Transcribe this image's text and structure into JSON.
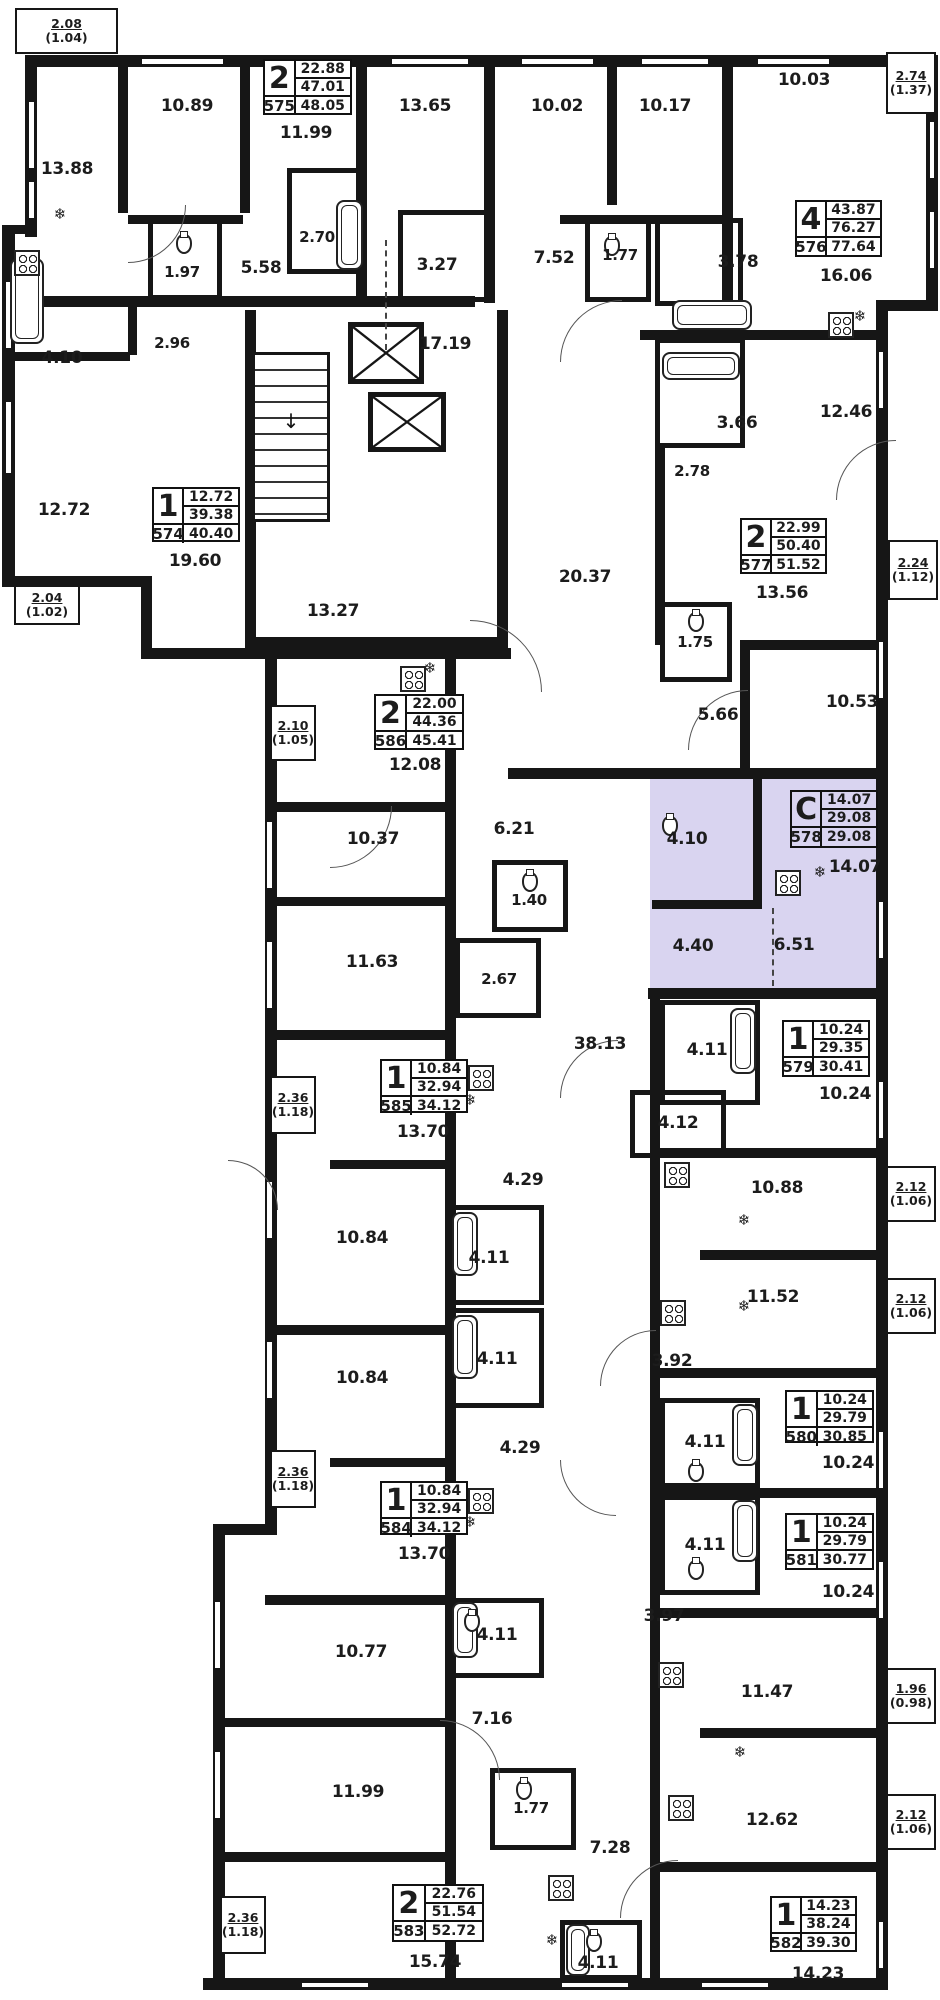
{
  "title": "Residential floor plan",
  "highlight": {
    "apartment_id": "578",
    "color": "#d9d4f0",
    "type_letter": "С"
  },
  "apartments": [
    {
      "id": "575",
      "rooms": "2",
      "values": [
        "22.88",
        "47.01",
        "48.05"
      ],
      "x": 263,
      "y": 59,
      "w": 89,
      "h": 56,
      "highlighted": false
    },
    {
      "id": "576",
      "rooms": "4",
      "values": [
        "43.87",
        "76.27",
        "77.64"
      ],
      "x": 795,
      "y": 200,
      "w": 87,
      "h": 57,
      "highlighted": false
    },
    {
      "id": "574",
      "rooms": "1",
      "values": [
        "12.72",
        "39.38",
        "40.40"
      ],
      "x": 152,
      "y": 487,
      "w": 88,
      "h": 55,
      "highlighted": false
    },
    {
      "id": "577",
      "rooms": "2",
      "values": [
        "22.99",
        "50.40",
        "51.52"
      ],
      "x": 740,
      "y": 518,
      "w": 87,
      "h": 56,
      "highlighted": false
    },
    {
      "id": "586",
      "rooms": "2",
      "values": [
        "22.00",
        "44.36",
        "45.41"
      ],
      "x": 374,
      "y": 694,
      "w": 90,
      "h": 56,
      "highlighted": false
    },
    {
      "id": "578",
      "rooms": "С",
      "values": [
        "14.07",
        "29.08",
        "29.08"
      ],
      "x": 790,
      "y": 790,
      "w": 88,
      "h": 58,
      "highlighted": true
    },
    {
      "id": "579",
      "rooms": "1",
      "values": [
        "10.24",
        "29.35",
        "30.41"
      ],
      "x": 782,
      "y": 1020,
      "w": 88,
      "h": 57,
      "highlighted": false
    },
    {
      "id": "585",
      "rooms": "1",
      "values": [
        "10.84",
        "32.94",
        "34.12"
      ],
      "x": 380,
      "y": 1059,
      "w": 88,
      "h": 54,
      "highlighted": false
    },
    {
      "id": "580",
      "rooms": "1",
      "values": [
        "10.24",
        "29.79",
        "30.85"
      ],
      "x": 785,
      "y": 1390,
      "w": 89,
      "h": 53,
      "highlighted": false
    },
    {
      "id": "581",
      "rooms": "1",
      "values": [
        "10.24",
        "29.79",
        "30.77"
      ],
      "x": 785,
      "y": 1513,
      "w": 89,
      "h": 57,
      "highlighted": false
    },
    {
      "id": "584",
      "rooms": "1",
      "values": [
        "10.84",
        "32.94",
        "34.12"
      ],
      "x": 380,
      "y": 1481,
      "w": 88,
      "h": 54,
      "highlighted": false
    },
    {
      "id": "583",
      "rooms": "2",
      "values": [
        "22.76",
        "51.54",
        "52.72"
      ],
      "x": 392,
      "y": 1884,
      "w": 92,
      "h": 58,
      "highlighted": false
    },
    {
      "id": "582",
      "rooms": "1",
      "values": [
        "14.23",
        "38.24",
        "39.30"
      ],
      "x": 770,
      "y": 1896,
      "w": 87,
      "h": 56,
      "highlighted": false
    }
  ],
  "room_labels": [
    {
      "t": "13.88",
      "x": 67,
      "y": 169
    },
    {
      "t": "10.89",
      "x": 187,
      "y": 106
    },
    {
      "t": "11.99",
      "x": 306,
      "y": 133
    },
    {
      "t": "13.65",
      "x": 425,
      "y": 106
    },
    {
      "t": "10.02",
      "x": 557,
      "y": 106
    },
    {
      "t": "10.17",
      "x": 665,
      "y": 106
    },
    {
      "t": "10.03",
      "x": 804,
      "y": 80
    },
    {
      "t": "2.70",
      "x": 317,
      "y": 237
    },
    {
      "t": "1.97",
      "x": 182,
      "y": 272
    },
    {
      "t": "5.58",
      "x": 261,
      "y": 268
    },
    {
      "t": "3.27",
      "x": 437,
      "y": 265
    },
    {
      "t": "7.52",
      "x": 554,
      "y": 258
    },
    {
      "t": "1.77",
      "x": 620,
      "y": 255
    },
    {
      "t": "3.78",
      "x": 738,
      "y": 262
    },
    {
      "t": "16.06",
      "x": 846,
      "y": 276
    },
    {
      "t": "2.96",
      "x": 172,
      "y": 343
    },
    {
      "t": "4.10",
      "x": 62,
      "y": 358
    },
    {
      "t": "17.19",
      "x": 445,
      "y": 344
    },
    {
      "t": "3.66",
      "x": 737,
      "y": 423
    },
    {
      "t": "12.46",
      "x": 846,
      "y": 412
    },
    {
      "t": "12.72",
      "x": 64,
      "y": 510
    },
    {
      "t": "19.60",
      "x": 195,
      "y": 561
    },
    {
      "t": "2.78",
      "x": 692,
      "y": 471
    },
    {
      "t": "13.56",
      "x": 782,
      "y": 593
    },
    {
      "t": "13.27",
      "x": 333,
      "y": 611
    },
    {
      "t": "20.37",
      "x": 585,
      "y": 577
    },
    {
      "t": "1.75",
      "x": 695,
      "y": 642
    },
    {
      "t": "5.66",
      "x": 718,
      "y": 715
    },
    {
      "t": "10.53",
      "x": 852,
      "y": 702
    },
    {
      "t": "12.08",
      "x": 415,
      "y": 765
    },
    {
      "t": "6.21",
      "x": 514,
      "y": 829
    },
    {
      "t": "10.37",
      "x": 373,
      "y": 839
    },
    {
      "t": "1.40",
      "x": 529,
      "y": 900
    },
    {
      "t": "11.63",
      "x": 372,
      "y": 962
    },
    {
      "t": "2.67",
      "x": 499,
      "y": 979
    },
    {
      "t": "4.10",
      "x": 687,
      "y": 839
    },
    {
      "t": "14.07",
      "x": 855,
      "y": 867
    },
    {
      "t": "4.40",
      "x": 693,
      "y": 946
    },
    {
      "t": "6.51",
      "x": 794,
      "y": 945
    },
    {
      "t": "38.13",
      "x": 600,
      "y": 1044
    },
    {
      "t": "4.11",
      "x": 707,
      "y": 1050
    },
    {
      "t": "10.24",
      "x": 845,
      "y": 1094
    },
    {
      "t": "4.12",
      "x": 678,
      "y": 1123
    },
    {
      "t": "10.88",
      "x": 777,
      "y": 1188
    },
    {
      "t": "13.70",
      "x": 423,
      "y": 1132
    },
    {
      "t": "10.84",
      "x": 362,
      "y": 1238
    },
    {
      "t": "4.11",
      "x": 489,
      "y": 1258
    },
    {
      "t": "4.29",
      "x": 523,
      "y": 1180
    },
    {
      "t": "11.52",
      "x": 773,
      "y": 1297
    },
    {
      "t": "3.92",
      "x": 672,
      "y": 1361
    },
    {
      "t": "10.24",
      "x": 848,
      "y": 1463
    },
    {
      "t": "4.11",
      "x": 705,
      "y": 1442
    },
    {
      "t": "4.11",
      "x": 497,
      "y": 1359
    },
    {
      "t": "10.84",
      "x": 362,
      "y": 1378
    },
    {
      "t": "4.29",
      "x": 520,
      "y": 1448
    },
    {
      "t": "10.24",
      "x": 848,
      "y": 1592
    },
    {
      "t": "4.11",
      "x": 705,
      "y": 1545
    },
    {
      "t": "13.70",
      "x": 424,
      "y": 1554
    },
    {
      "t": "3.97",
      "x": 664,
      "y": 1616
    },
    {
      "t": "10.77",
      "x": 361,
      "y": 1652
    },
    {
      "t": "4.11",
      "x": 497,
      "y": 1635
    },
    {
      "t": "7.16",
      "x": 492,
      "y": 1719
    },
    {
      "t": "11.47",
      "x": 767,
      "y": 1692
    },
    {
      "t": "11.99",
      "x": 358,
      "y": 1792
    },
    {
      "t": "1.77",
      "x": 531,
      "y": 1808
    },
    {
      "t": "7.28",
      "x": 610,
      "y": 1848
    },
    {
      "t": "12.62",
      "x": 772,
      "y": 1820
    },
    {
      "t": "4.11",
      "x": 598,
      "y": 1963
    },
    {
      "t": "15.74",
      "x": 435,
      "y": 1962
    },
    {
      "t": "14.23",
      "x": 818,
      "y": 1974
    }
  ],
  "balconies": [
    {
      "a": "2.08",
      "b": "(1.04)",
      "x": 15,
      "y": 8,
      "w": 103,
      "h": 46
    },
    {
      "a": "2.74",
      "b": "(1.37)",
      "x": 886,
      "y": 52,
      "w": 50,
      "h": 62
    },
    {
      "a": "2.04",
      "b": "(1.02)",
      "x": 14,
      "y": 585,
      "w": 66,
      "h": 40
    },
    {
      "a": "2.24",
      "b": "(1.12)",
      "x": 888,
      "y": 540,
      "w": 50,
      "h": 60
    },
    {
      "a": "2.10",
      "b": "(1.05)",
      "x": 270,
      "y": 705,
      "w": 46,
      "h": 56
    },
    {
      "a": "2.36",
      "b": "(1.18)",
      "x": 270,
      "y": 1076,
      "w": 46,
      "h": 58
    },
    {
      "a": "2.12",
      "b": "(1.06)",
      "x": 886,
      "y": 1166,
      "w": 50,
      "h": 56
    },
    {
      "a": "2.12",
      "b": "(1.06)",
      "x": 886,
      "y": 1278,
      "w": 50,
      "h": 56
    },
    {
      "a": "2.36",
      "b": "(1.18)",
      "x": 270,
      "y": 1450,
      "w": 46,
      "h": 58
    },
    {
      "a": "1.96",
      "b": "(0.98)",
      "x": 886,
      "y": 1668,
      "w": 50,
      "h": 56
    },
    {
      "a": "2.12",
      "b": "(1.06)",
      "x": 886,
      "y": 1794,
      "w": 50,
      "h": 56
    },
    {
      "a": "2.36",
      "b": "(1.18)",
      "x": 220,
      "y": 1896,
      "w": 46,
      "h": 58
    }
  ]
}
